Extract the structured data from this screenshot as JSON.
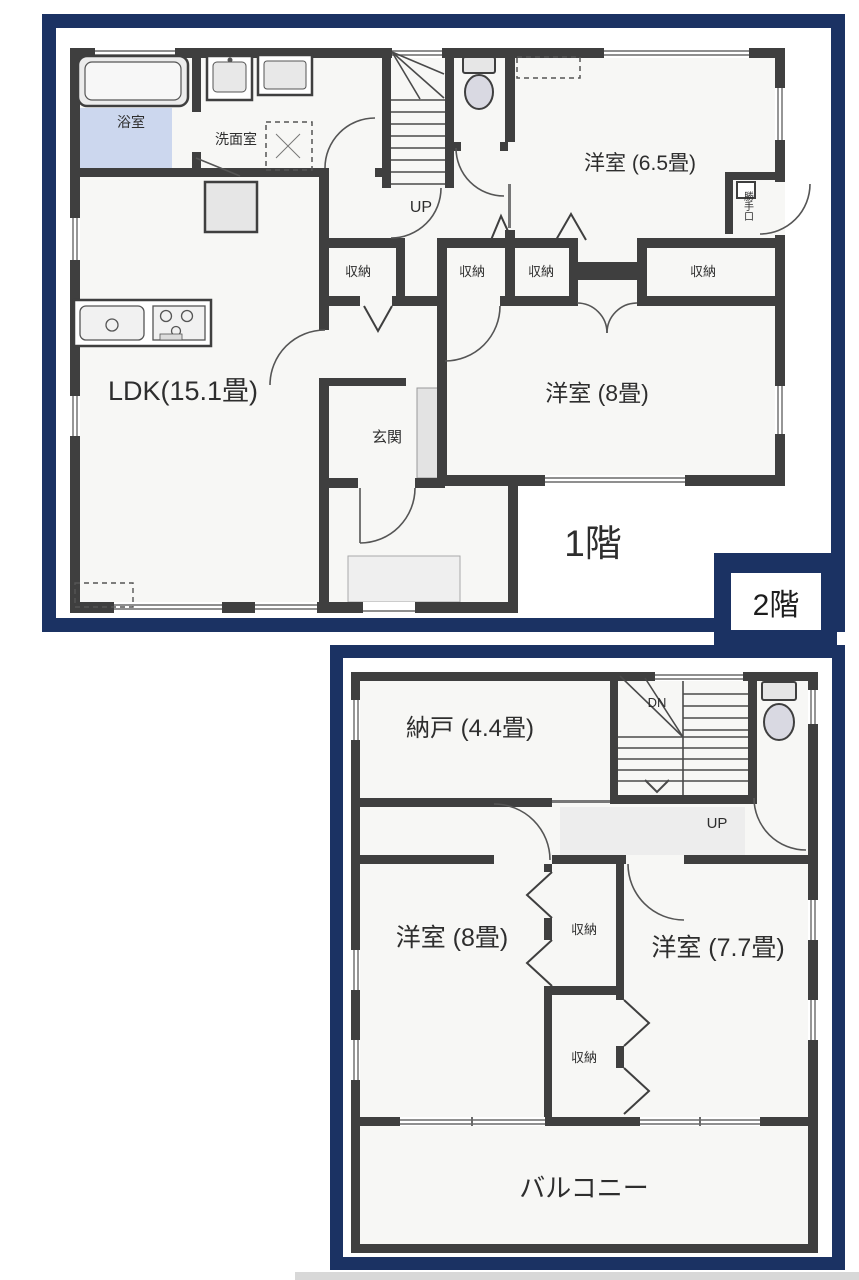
{
  "colors": {
    "frame_navy": "#1b3263",
    "wall_gray": "#3f3f3f",
    "bath_blue": "#ccd7ee"
  },
  "floor1": {
    "title": "1階",
    "bath": "浴室",
    "washroom": "洗面室",
    "ldk": "LDK(15.1畳)",
    "western_6_5": "洋室 (6.5畳)",
    "western_8": "洋室 (8畳)",
    "entrance": "玄関",
    "stairs_up": "UP",
    "back_door": "勝手口",
    "closets": [
      "収納",
      "収納",
      "収納",
      "収納"
    ]
  },
  "floor2": {
    "title": "2階",
    "storage_room": "納戸 (4.4畳)",
    "western_8": "洋室 (8畳)",
    "western_7_7": "洋室 (7.7畳)",
    "balcony": "バルコニー",
    "stairs_down": "DN",
    "stairs_up": "UP",
    "closets": [
      "収納",
      "収納"
    ]
  }
}
